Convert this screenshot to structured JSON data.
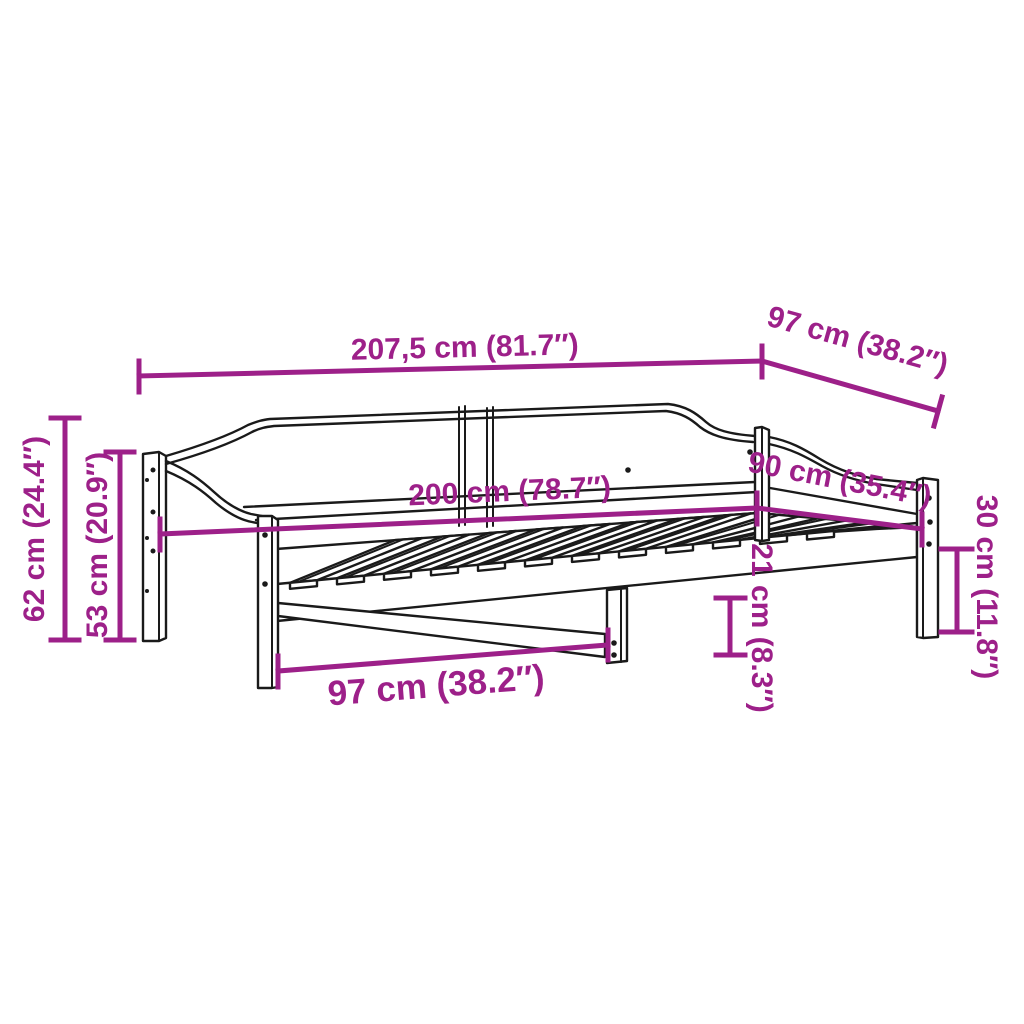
{
  "title": "Daybed frame dimension diagram",
  "colors": {
    "accent": "#9d2089",
    "line": "#1a1a1a",
    "background": "#ffffff"
  },
  "dimensions": {
    "total_length": "207,5 cm (81.7″)",
    "total_depth": "97 cm (38.2″)",
    "inner_length": "200 cm (78.7″)",
    "inner_width": "90 cm (35.4″)",
    "back_height": "62 cm (24.4″)",
    "backrest_height": "53 cm (20.9″)",
    "leg_spacing": "97 cm (38.2″)",
    "underbed_clearance": "21 cm (8.3″)",
    "side_height": "30 cm (11.8″)"
  }
}
